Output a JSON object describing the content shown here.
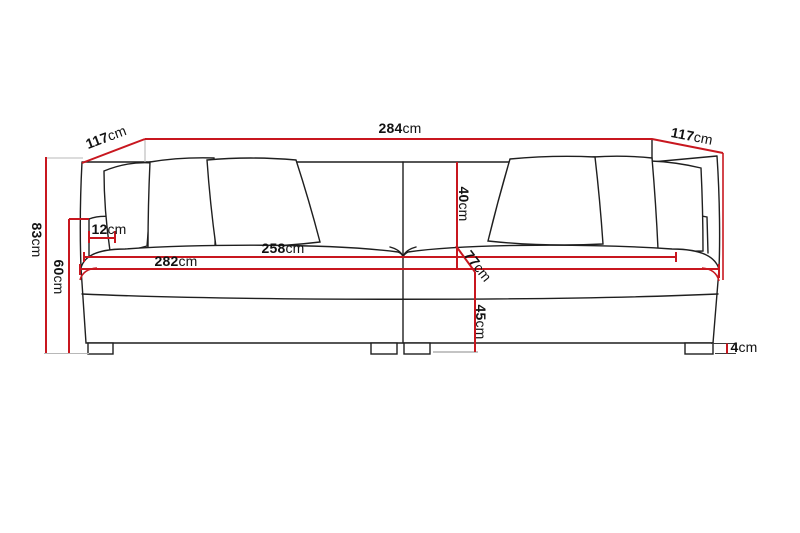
{
  "figure": {
    "type": "sofa-dimension-diagram",
    "unit": "cm"
  },
  "dimensions": {
    "total_width": {
      "value": "284",
      "unit": "cm"
    },
    "depth_left": {
      "value": "117",
      "unit": "cm"
    },
    "depth_right": {
      "value": "117",
      "unit": "cm"
    },
    "total_height": {
      "value": "83",
      "unit": "cm"
    },
    "arm_height": {
      "value": "60",
      "unit": "cm"
    },
    "arm_width": {
      "value": "12",
      "unit": "cm"
    },
    "inner_width": {
      "value": "258",
      "unit": "cm"
    },
    "seat_width": {
      "value": "282",
      "unit": "cm"
    },
    "back_cushion_height": {
      "value": "40",
      "unit": "cm"
    },
    "seat_depth": {
      "value": "77",
      "unit": "cm"
    },
    "seat_height": {
      "value": "45",
      "unit": "cm"
    },
    "leg_height": {
      "value": "4",
      "unit": "cm"
    }
  },
  "colors": {
    "dimension_line": "#c8171f",
    "artwork_line": "#1f1f1f",
    "extension_line": "#b8b8b8",
    "background": "#ffffff",
    "label_text": "#121212"
  }
}
